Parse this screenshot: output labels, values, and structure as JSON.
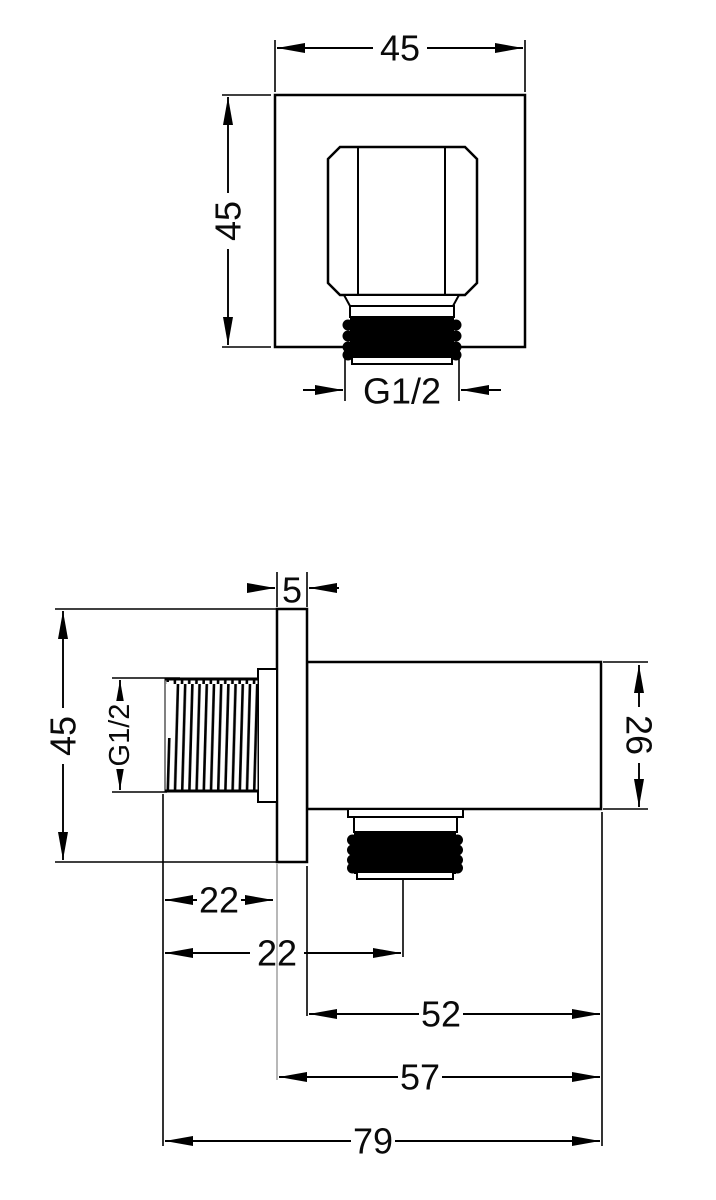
{
  "dimensions": {
    "front": {
      "width": "45",
      "height": "45",
      "thread": "G1/2"
    },
    "side": {
      "plate_thickness": "5",
      "height": "45",
      "thread": "G1/2",
      "body_height": "26",
      "thread_length": "22",
      "outlet_offset": "22",
      "body_length": "52",
      "body_plus_plate": "57",
      "overall_length": "79"
    }
  },
  "colors": {
    "line": "#000000",
    "background": "#ffffff",
    "thread_fill": "#000000",
    "light_line": "#9a9a9a"
  }
}
